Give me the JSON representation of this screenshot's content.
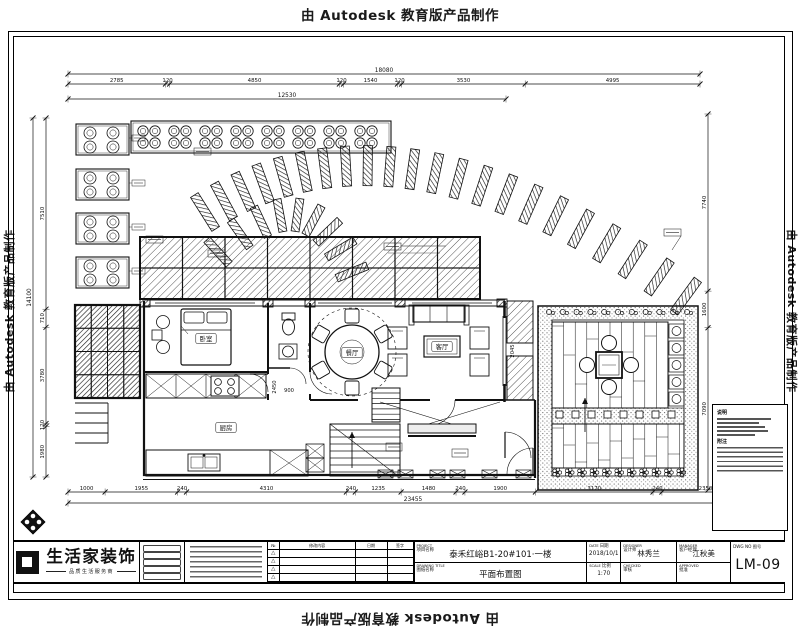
{
  "banner": {
    "text": "由 Autodesk 教育版产品制作"
  },
  "title_block": {
    "logo": {
      "name": "生活家装饰",
      "tagline": "品质生活服务商"
    },
    "project": {
      "label_en": "PROJECT",
      "label_cn": "项目名称",
      "value": "泰禾红峪B1-20#101·一楼"
    },
    "drawing": {
      "label_en": "DRAWING TITLE",
      "label_cn": "图纸名称",
      "value": "平面布置图"
    },
    "date": {
      "label_en": "DATE",
      "label_cn": "日期",
      "value": "2018/10/1"
    },
    "scale": {
      "label_en": "SCALE",
      "label_cn": "比例",
      "value": "1:70"
    },
    "designer": {
      "label_en": "DESIGNER",
      "label_cn": "设计师",
      "value": "林秀兰"
    },
    "checker": {
      "label_en": "CHECKED",
      "label_cn": "审核",
      "value": ""
    },
    "manager": {
      "label_en": "MANAGER",
      "label_cn": "客户经理",
      "value": "江秋美"
    },
    "approver": {
      "label_en": "APPROVED",
      "label_cn": "批准",
      "value": ""
    },
    "dwg": {
      "label": "DWG NO 图号",
      "value": "LM-09"
    },
    "revision": {
      "headers": [
        "№",
        "修改内容",
        "日期",
        "签字"
      ],
      "marker": "△",
      "row_count": 4
    }
  },
  "plan": {
    "notes_box": {
      "title": "说明",
      "subtitle": "附注"
    },
    "room_labels": [
      {
        "text": "卧室",
        "x": 206,
        "y": 339
      },
      {
        "text": "餐厅",
        "x": 352,
        "y": 353
      },
      {
        "text": "客厅",
        "x": 442,
        "y": 347
      },
      {
        "text": "厨房",
        "x": 226,
        "y": 428
      }
    ],
    "inline_dims": [
      {
        "text": "900",
        "x": 289,
        "y": 392,
        "rot": 0
      },
      {
        "text": "2045",
        "x": 514,
        "y": 351,
        "rot": -90
      },
      {
        "text": "2450",
        "x": 276,
        "y": 387,
        "rot": -90
      }
    ],
    "dims": {
      "top_overall": "18080",
      "top": [
        "2785",
        "120",
        "4850",
        "120",
        "1540",
        "120",
        "3530",
        "4995"
      ],
      "top_sub": "12530",
      "bottom": [
        "1000",
        "1955",
        "240",
        "4310",
        "240",
        "1235",
        "1480",
        "240",
        "1900",
        "3170",
        "240",
        "2350",
        "240"
      ],
      "bottom_overall": "23455",
      "left": [
        "7510",
        "710",
        "3780",
        "120",
        "1980"
      ],
      "left_overall": "14100",
      "right": [
        "7740",
        "1600",
        "7090"
      ]
    }
  }
}
